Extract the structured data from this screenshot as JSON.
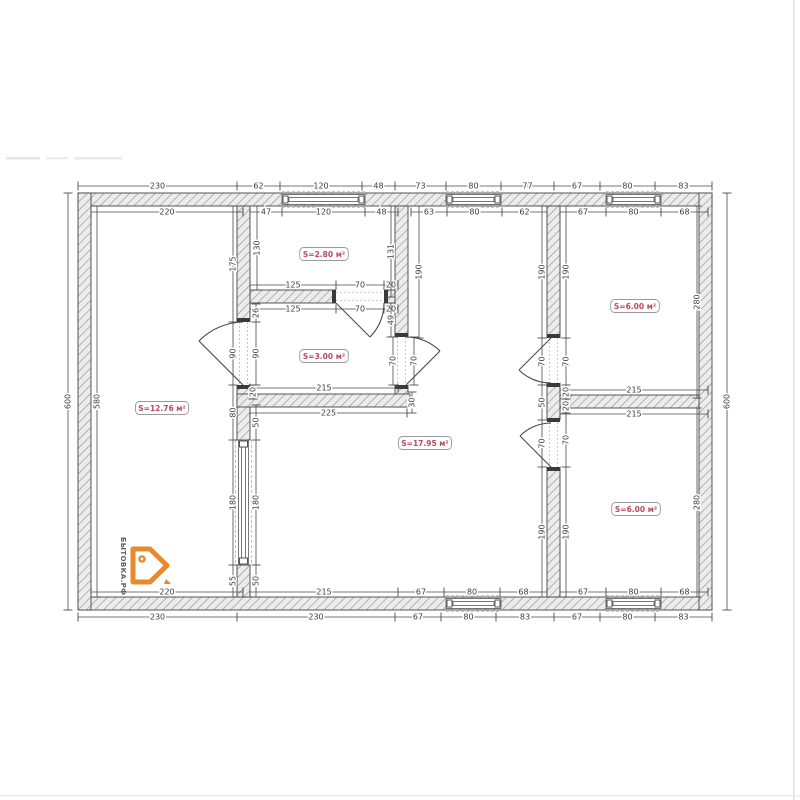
{
  "logo": {
    "text": "БЫТОВКА.РФ",
    "accent_color": "#e8892f"
  },
  "rooms": [
    {
      "x": 162,
      "y": 408,
      "t": "S=12.76 м²"
    },
    {
      "x": 324,
      "y": 254,
      "t": "S=2.80 м²"
    },
    {
      "x": 324,
      "y": 356,
      "t": "S=3.00 м²"
    },
    {
      "x": 425,
      "y": 443,
      "t": "S=17.95 м²"
    },
    {
      "x": 635,
      "y": 306,
      "t": "S=6.00 м²"
    },
    {
      "x": 636,
      "y": 509,
      "t": "S=6.00 м²"
    }
  ],
  "dim_chains": [
    {
      "o": "h",
      "c": 186,
      "t": [
        78,
        237,
        280,
        362,
        395,
        446,
        501,
        554,
        600,
        655,
        712
      ],
      "l": [
        "230",
        "62",
        "120",
        "48",
        "73",
        "80",
        "77",
        "67",
        "80",
        "83"
      ]
    },
    {
      "o": "h",
      "c": 212,
      "t": [
        91,
        243
      ],
      "l": [
        "220"
      ]
    },
    {
      "o": "h",
      "c": 212,
      "t": [
        250,
        282,
        365,
        398
      ],
      "l": [
        "47",
        "120",
        "48"
      ]
    },
    {
      "o": "h",
      "c": 212,
      "t": [
        411,
        447,
        502,
        547
      ],
      "l": [
        "63",
        "80",
        "62"
      ]
    },
    {
      "o": "h",
      "c": 212,
      "t": [
        560,
        606,
        661,
        708
      ],
      "l": [
        "67",
        "80",
        "68"
      ]
    },
    {
      "o": "h",
      "c": 285,
      "t": [
        250,
        336,
        384,
        398
      ],
      "l": [
        "125",
        "70",
        "20"
      ]
    },
    {
      "o": "h",
      "c": 309,
      "t": [
        250,
        336,
        384,
        398
      ],
      "l": [
        "125",
        "70",
        "20"
      ]
    },
    {
      "o": "h",
      "c": 388,
      "t": [
        250,
        398
      ],
      "l": [
        "215"
      ]
    },
    {
      "o": "h",
      "c": 413,
      "t": [
        250,
        407
      ],
      "l": [
        "225"
      ]
    },
    {
      "o": "h",
      "c": 390,
      "t": [
        560,
        708
      ],
      "l": [
        "215"
      ]
    },
    {
      "o": "h",
      "c": 414,
      "t": [
        560,
        708
      ],
      "l": [
        "215"
      ]
    },
    {
      "o": "h",
      "c": 592,
      "t": [
        91,
        243
      ],
      "l": [
        "220"
      ]
    },
    {
      "o": "h",
      "c": 592,
      "t": [
        250,
        398,
        444,
        500,
        547
      ],
      "l": [
        "215",
        "67",
        "80",
        "68"
      ]
    },
    {
      "o": "h",
      "c": 592,
      "t": [
        560,
        606,
        661,
        708
      ],
      "l": [
        "67",
        "80",
        "68"
      ]
    },
    {
      "o": "h",
      "c": 617,
      "t": [
        78,
        237,
        395,
        441,
        496,
        554,
        600,
        655,
        712
      ],
      "l": [
        "230",
        "230",
        "67",
        "80",
        "83",
        "67",
        "80",
        "83"
      ]
    },
    {
      "o": "v",
      "c": 68,
      "t": [
        193,
        610
      ],
      "l": [
        "600"
      ]
    },
    {
      "o": "v",
      "c": 97,
      "t": [
        206,
        597
      ],
      "l": [
        "580"
      ]
    },
    {
      "o": "v",
      "c": 727,
      "t": [
        193,
        610
      ],
      "l": [
        "600"
      ]
    },
    {
      "o": "v",
      "c": 233,
      "t": [
        206,
        322,
        385,
        440,
        565,
        597
      ],
      "l": [
        "175",
        "90",
        "80",
        "180",
        "55"
      ]
    },
    {
      "o": "v",
      "c": 256,
      "t": [
        304,
        322,
        385
      ],
      "l": [
        "26",
        "90"
      ]
    },
    {
      "o": "v",
      "c": 256,
      "t": [
        405,
        440,
        565,
        597
      ],
      "l": [
        "50",
        "180",
        "50"
      ]
    },
    {
      "o": "v",
      "c": 253,
      "t": [
        385,
        399
      ],
      "l": [
        "20"
      ]
    },
    {
      "o": "v",
      "c": 257,
      "t": [
        206,
        290
      ],
      "l": [
        "130"
      ]
    },
    {
      "o": "v",
      "c": 391,
      "t": [
        206,
        297
      ],
      "l": [
        "131"
      ]
    },
    {
      "o": "v",
      "c": 391,
      "t": [
        303,
        337
      ],
      "l": [
        "49"
      ]
    },
    {
      "o": "v",
      "c": 393,
      "t": [
        337,
        385
      ],
      "l": [
        "70"
      ]
    },
    {
      "o": "v",
      "c": 414,
      "t": [
        337,
        385
      ],
      "l": [
        "70"
      ]
    },
    {
      "o": "v",
      "c": 419,
      "t": [
        206,
        338
      ],
      "l": [
        "190"
      ]
    },
    {
      "o": "v",
      "c": 412,
      "t": [
        392,
        413
      ],
      "l": [
        "30"
      ]
    },
    {
      "o": "v",
      "c": 542,
      "t": [
        206,
        338,
        385,
        420,
        467,
        597
      ],
      "l": [
        "190",
        "70",
        "50",
        "70",
        "190"
      ]
    },
    {
      "o": "v",
      "c": 566,
      "t": [
        206,
        338,
        385,
        399,
        413,
        467,
        597
      ],
      "l": [
        "190",
        "70",
        "20",
        "20",
        "70",
        "190"
      ]
    },
    {
      "o": "v",
      "c": 697,
      "t": [
        206,
        398
      ],
      "l": [
        "280"
      ]
    },
    {
      "o": "v",
      "c": 697,
      "t": [
        408,
        597
      ],
      "l": [
        "280"
      ]
    }
  ]
}
